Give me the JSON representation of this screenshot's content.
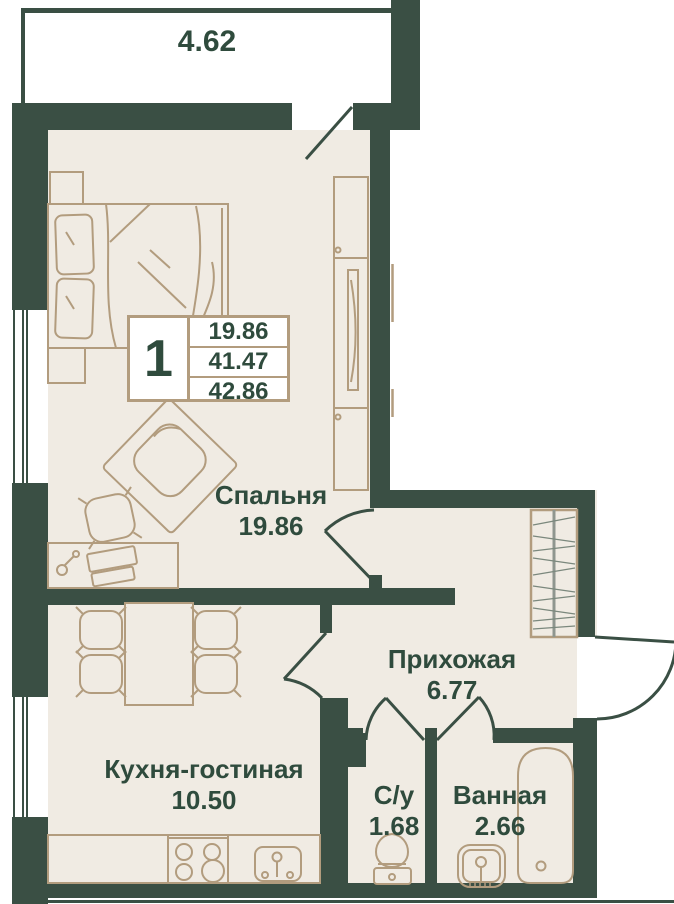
{
  "colors": {
    "wall": "#3a4f44",
    "floor": "#f0ebe3",
    "line": "#b29c7e",
    "text": "#2f4b3d",
    "hatch": "#7b887d",
    "white": "#ffffff"
  },
  "balcony": {
    "area": "4.62"
  },
  "info_box": {
    "rooms": "1",
    "values": [
      "19.86",
      "41.47",
      "42.86"
    ]
  },
  "rooms": [
    {
      "id": "bedroom",
      "label": "Спальня",
      "area": "19.86"
    },
    {
      "id": "hallway",
      "label": "Прихожая",
      "area": "6.77"
    },
    {
      "id": "kitchen",
      "label": "Кухня-гостиная",
      "area": "10.50"
    },
    {
      "id": "wc",
      "label": "С/у",
      "area": "1.68"
    },
    {
      "id": "bathroom",
      "label": "Ванная",
      "area": "2.66"
    }
  ]
}
